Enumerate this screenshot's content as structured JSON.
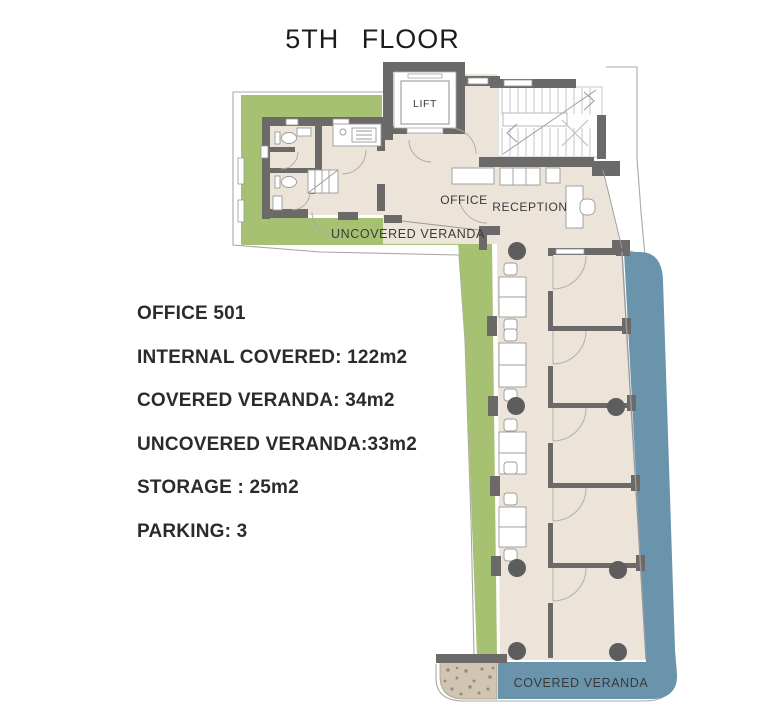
{
  "title": "5TH FLOOR",
  "info": {
    "lines": [
      "OFFICE 501",
      "INTERNAL COVERED: 122m2",
      "COVERED VERANDA: 34m2",
      "UNCOVERED VERANDA:33m2",
      "STORAGE : 25m2",
      "PARKING: 3"
    ]
  },
  "plan": {
    "labels": {
      "lift": "LIFT",
      "office": "OFFICE",
      "reception": "RECEPTION",
      "uncovered_veranda": "UNCOVERED VERANDA",
      "covered_veranda": "COVERED VERANDA"
    }
  },
  "colors": {
    "veranda_green": "#a7c172",
    "veranda_blue": "#6994ab",
    "wall_gray": "#6b6a68",
    "floor_beige": "#ece4d9",
    "gravel_tan": "#cfc5b2",
    "column_gray": "#5d5d5d",
    "outline_gray": "#a8a8a8"
  }
}
